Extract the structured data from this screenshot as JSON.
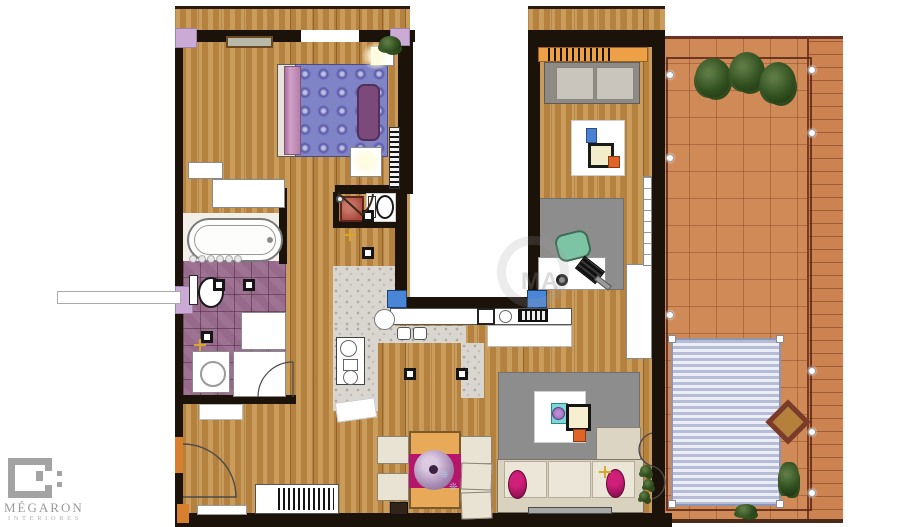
{
  "brand": {
    "name": "MÉGARON",
    "tagline": "INTERIORES"
  },
  "watermark": {
    "text": "MA"
  },
  "palette": {
    "wall": "#1b120a",
    "wood_base": "#b5813e",
    "terracotta": "#d08a58",
    "bathroom_tile": "#97698b",
    "terrazzo": "#d9d5cf",
    "lilac_column": "#cbaad6",
    "window_blue": "#4a86d8",
    "accent_orange": "#e2712c",
    "magenta_cushion": "#b5156a",
    "bed_violet": "#7e84c6",
    "bed_runner_pink": "#c38cba",
    "headboard_purple": "#7c4a7a",
    "sofa_cream": "#e9e3d4",
    "rug_gray": "#8d8d8d",
    "chair_teal": "#7cc4a4",
    "pergola_blue": "#b6bbd6",
    "plant_green": "#31501f",
    "light_gold": "#d8a62a",
    "logo_gray": "#a3a3a3"
  },
  "plan": {
    "rooms": [
      "bedroom",
      "wardrobe",
      "bathroom",
      "wc",
      "kitchen",
      "hallway",
      "dining-area",
      "living-room",
      "study",
      "patio",
      "terrace"
    ],
    "furniture": [
      "double-bed",
      "nightstands",
      "bathtub",
      "toilet",
      "washing-machine",
      "vanity",
      "kitchen-counter",
      "double-sink",
      "hob",
      "oven",
      "bar-cart",
      "dining-table",
      "dining-chairs",
      "sideboard",
      "bookcase",
      "sofa",
      "armchairs",
      "coffee-table",
      "chaise-longue",
      "tv-bench",
      "study-sofa",
      "desk",
      "office-chair",
      "laptop",
      "pergola-awning",
      "terrace-table",
      "planters"
    ]
  }
}
